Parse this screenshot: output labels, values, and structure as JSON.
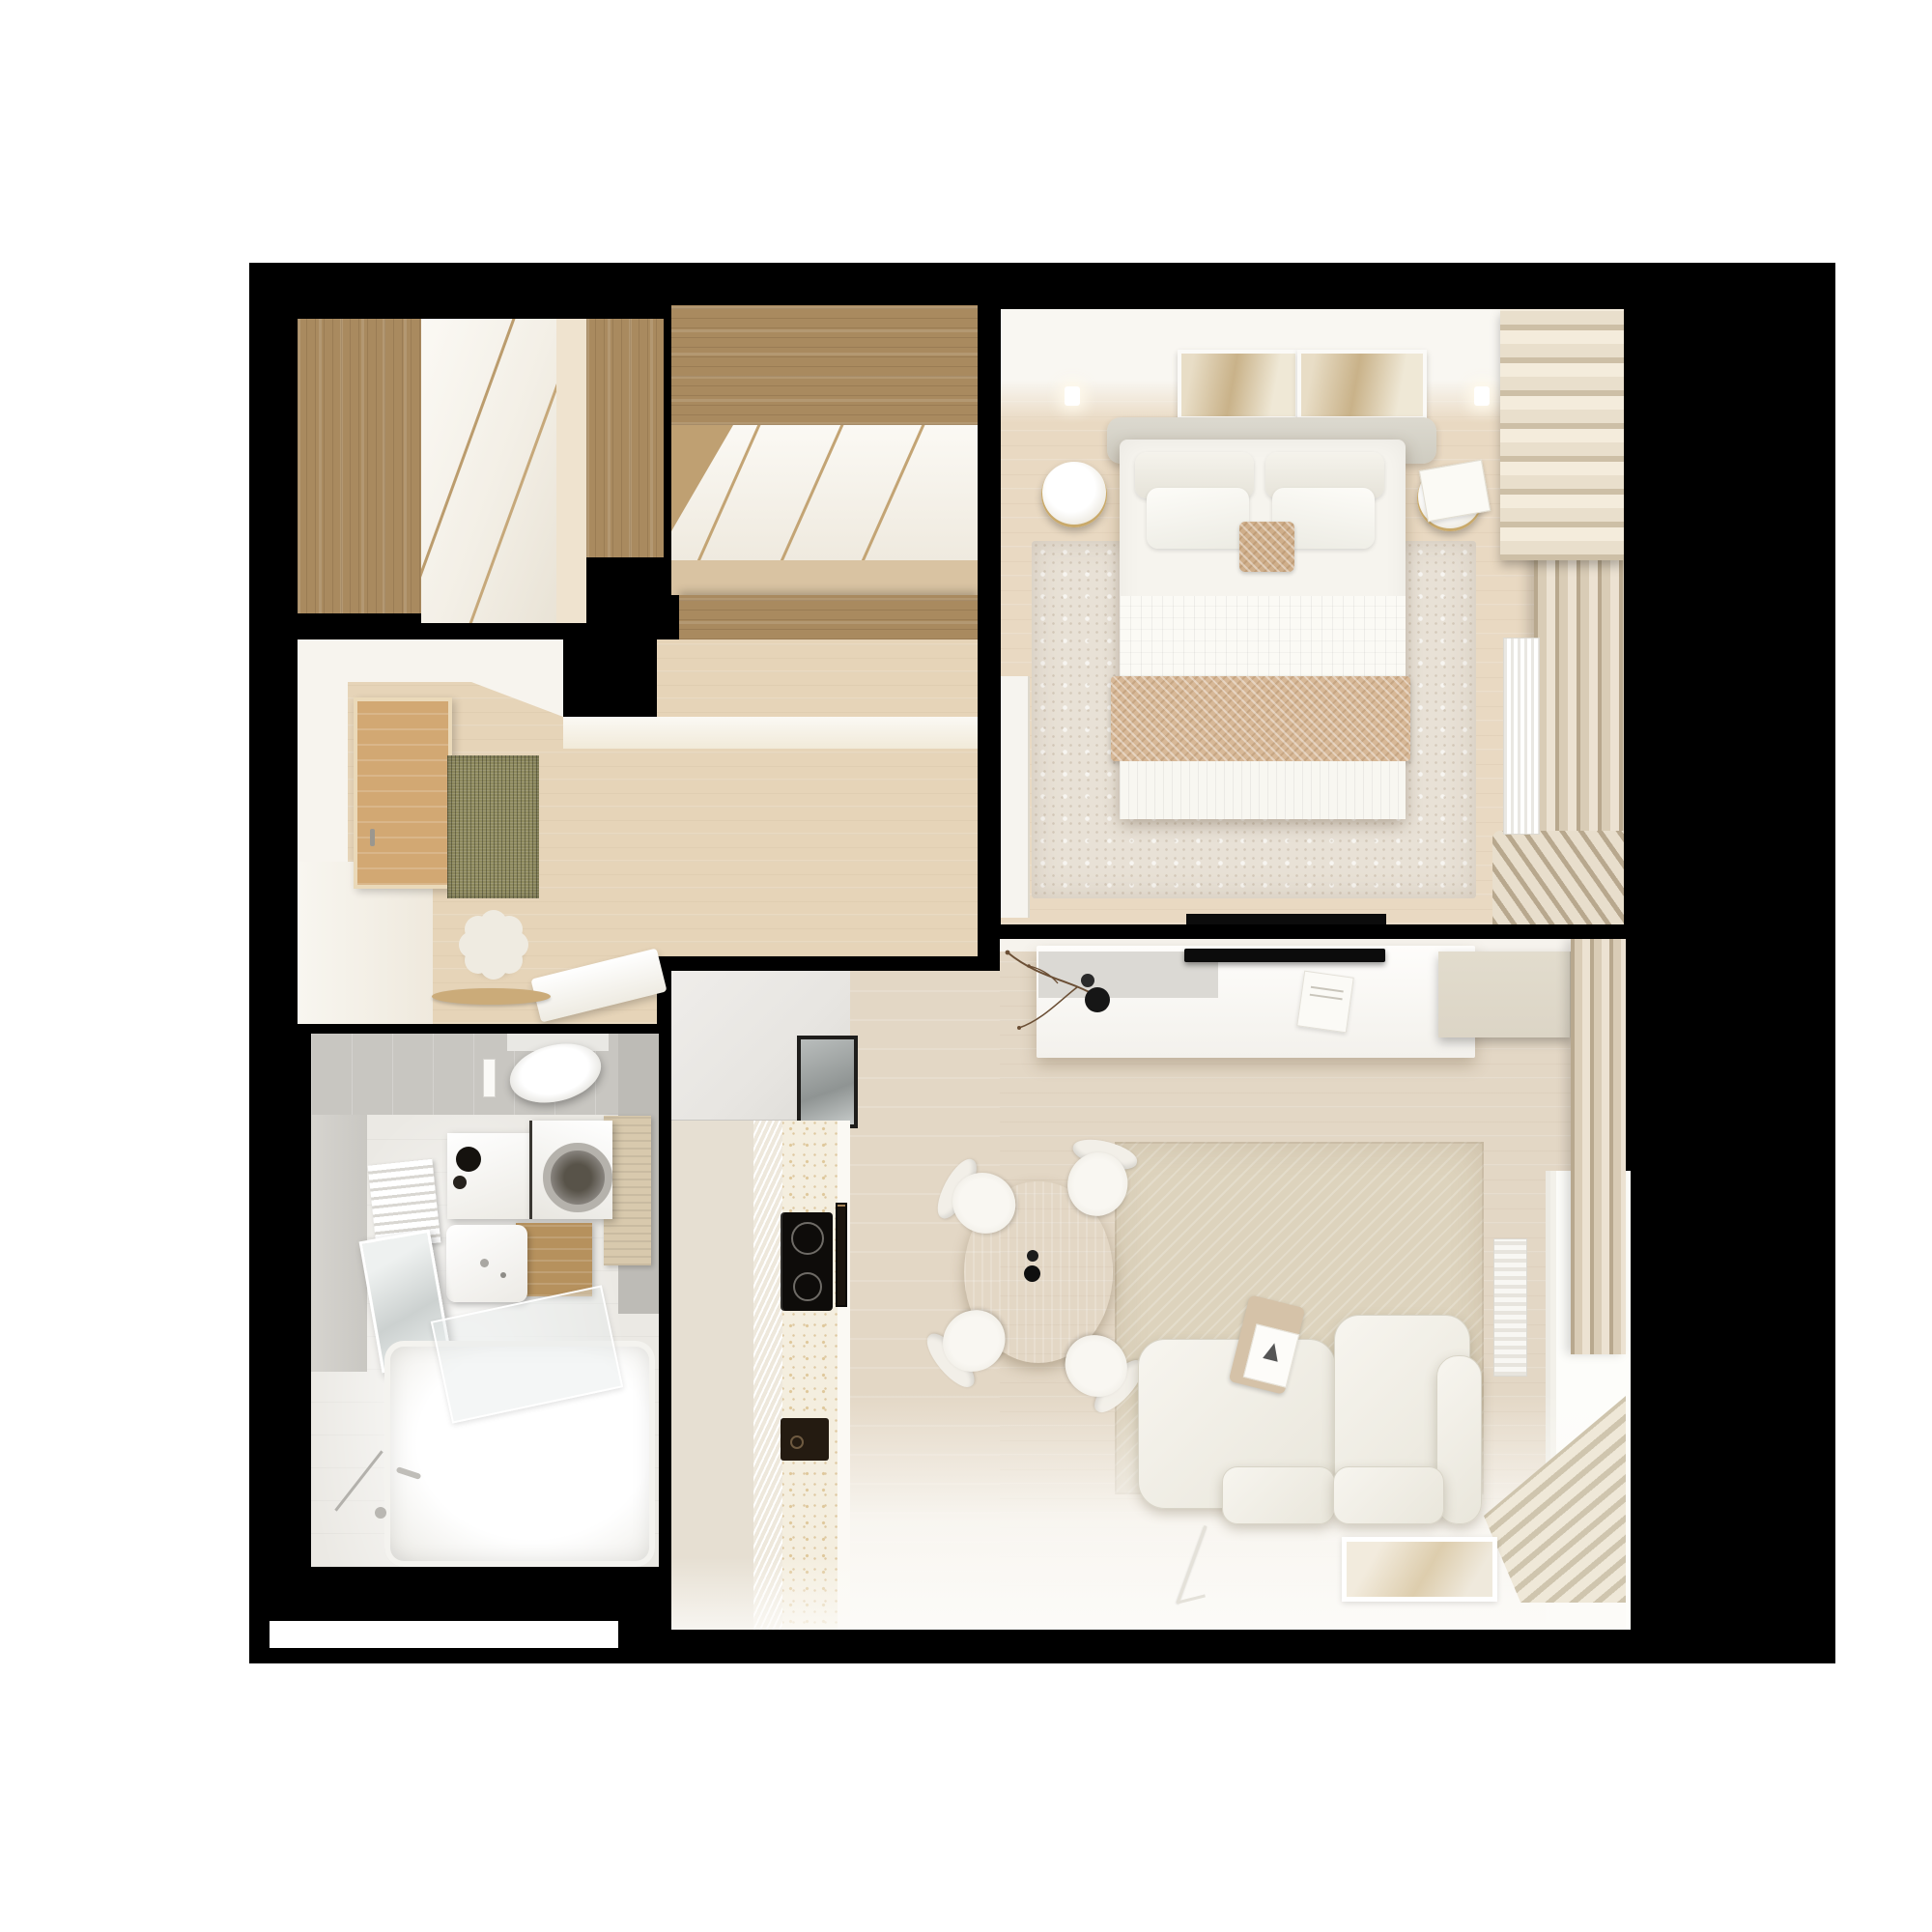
{
  "scene": {
    "type": "3d-floor-plan-render",
    "view": "top-down",
    "label": "Small apartment furnished floor plan render on black background"
  },
  "rooms": [
    {
      "id": "closet",
      "label": "Hall closet with wood wardrobes and sliding doors",
      "furniture": [
        "wood wardrobe column left",
        "white sliding doors",
        "wood wardrobe column right",
        "wood floor strip"
      ]
    },
    {
      "id": "wardrobe",
      "label": "Walk-in wardrobe with wood cabinets and angled sliding doors",
      "furniture": [
        "upper wood cabinet",
        "three angled white door panels",
        "wood floor",
        "lower wood cabinet"
      ]
    },
    {
      "id": "bedroom",
      "label": "Bedroom",
      "furniture": [
        "double bed with white bedding",
        "upholstered headboard",
        "four pillows",
        "beige herringbone cushion",
        "herringbone throw blanket",
        "round nightstand left",
        "round nightstand right",
        "book on nightstand",
        "two framed artworks",
        "two wall sconces",
        "distressed area rug",
        "open door leaf",
        "wall TV edge",
        "roman shade",
        "floor-length curtains",
        "window radiator"
      ]
    },
    {
      "id": "hallway",
      "label": "Entry hall and corridor",
      "furniture": [
        "wooden entrance door",
        "door handle",
        "olive doormat",
        "flower-shaped pouf",
        "white bench",
        "round wood tray"
      ]
    },
    {
      "id": "bathroom",
      "label": "Bathroom",
      "furniture": [
        "wall-hung toilet",
        "flush plate",
        "white vanity with black basin accessories",
        "washing machine",
        "wood drawer cabinet",
        "white washbasin",
        "towel radiator",
        "LED mirror",
        "glass bath screen",
        "bathtub with chrome fittings",
        "beige towel"
      ]
    },
    {
      "id": "living",
      "label": "Living room with kitchen and dining",
      "furniture": [
        "tall gray kitchen cabinets",
        "dark-framed glass panel",
        "fluted cabinet front",
        "terrazzo counter",
        "induction hob",
        "counter vent",
        "dark sink",
        "floating white sideboard",
        "gray tray with black vases and branch",
        "white book",
        "wall TV",
        "beige storage cabinet",
        "textured area rug",
        "round wood dining table",
        "two black table vases",
        "four white chairs",
        "modular white sofa",
        "throw with book on backrest",
        "framed poster on floor",
        "thin floor lamp",
        "curtains",
        "window",
        "slatted radiator",
        "ribbed corner radiator"
      ]
    }
  ],
  "scale_bar": {
    "label": ""
  },
  "palette": {
    "page": "#ffffff",
    "frame": "#000000",
    "wall": "#f7f4ee",
    "wallSoft": "#e6dfd2",
    "woodCab": "#a98a5f",
    "woodDoor": "#d2a873",
    "floorWarm": "#e6d4b8",
    "floorPale": "#efe3cf",
    "floorWardrobe": "#d9c3a2",
    "floorLiving": "#e3d7c5",
    "rugBed": "#e8e1d6",
    "rugLiving": "#ddd3bd",
    "curtain": "#d9ccb6",
    "curtainDark": "#b8a88e",
    "shade": "#e9dfcc",
    "tileGray": "#c8c6c1",
    "tileLight": "#d6d4cf",
    "bathFloor": "#ebe9e4",
    "terrazzo": "#f4eedf",
    "speckle": "#dfc89b",
    "sofa": "#f0eee6",
    "sofaEdge": "#d8d4c7",
    "cabinetGray": "#e7e5e1",
    "cabinetBeige": "#dcd5c6",
    "towel": "#d8c9ad",
    "doormat": "#8e8a5e",
    "appliance": "#15120e",
    "tv": "#0c0c0c",
    "tableWood": "#e7d2ab",
    "throw": "#d7b897",
    "cushion": "#cfae8a",
    "glass": "#dfe3e2",
    "brass": "#c9a96a",
    "branch": "#6b4f35",
    "white": "#ffffff"
  }
}
